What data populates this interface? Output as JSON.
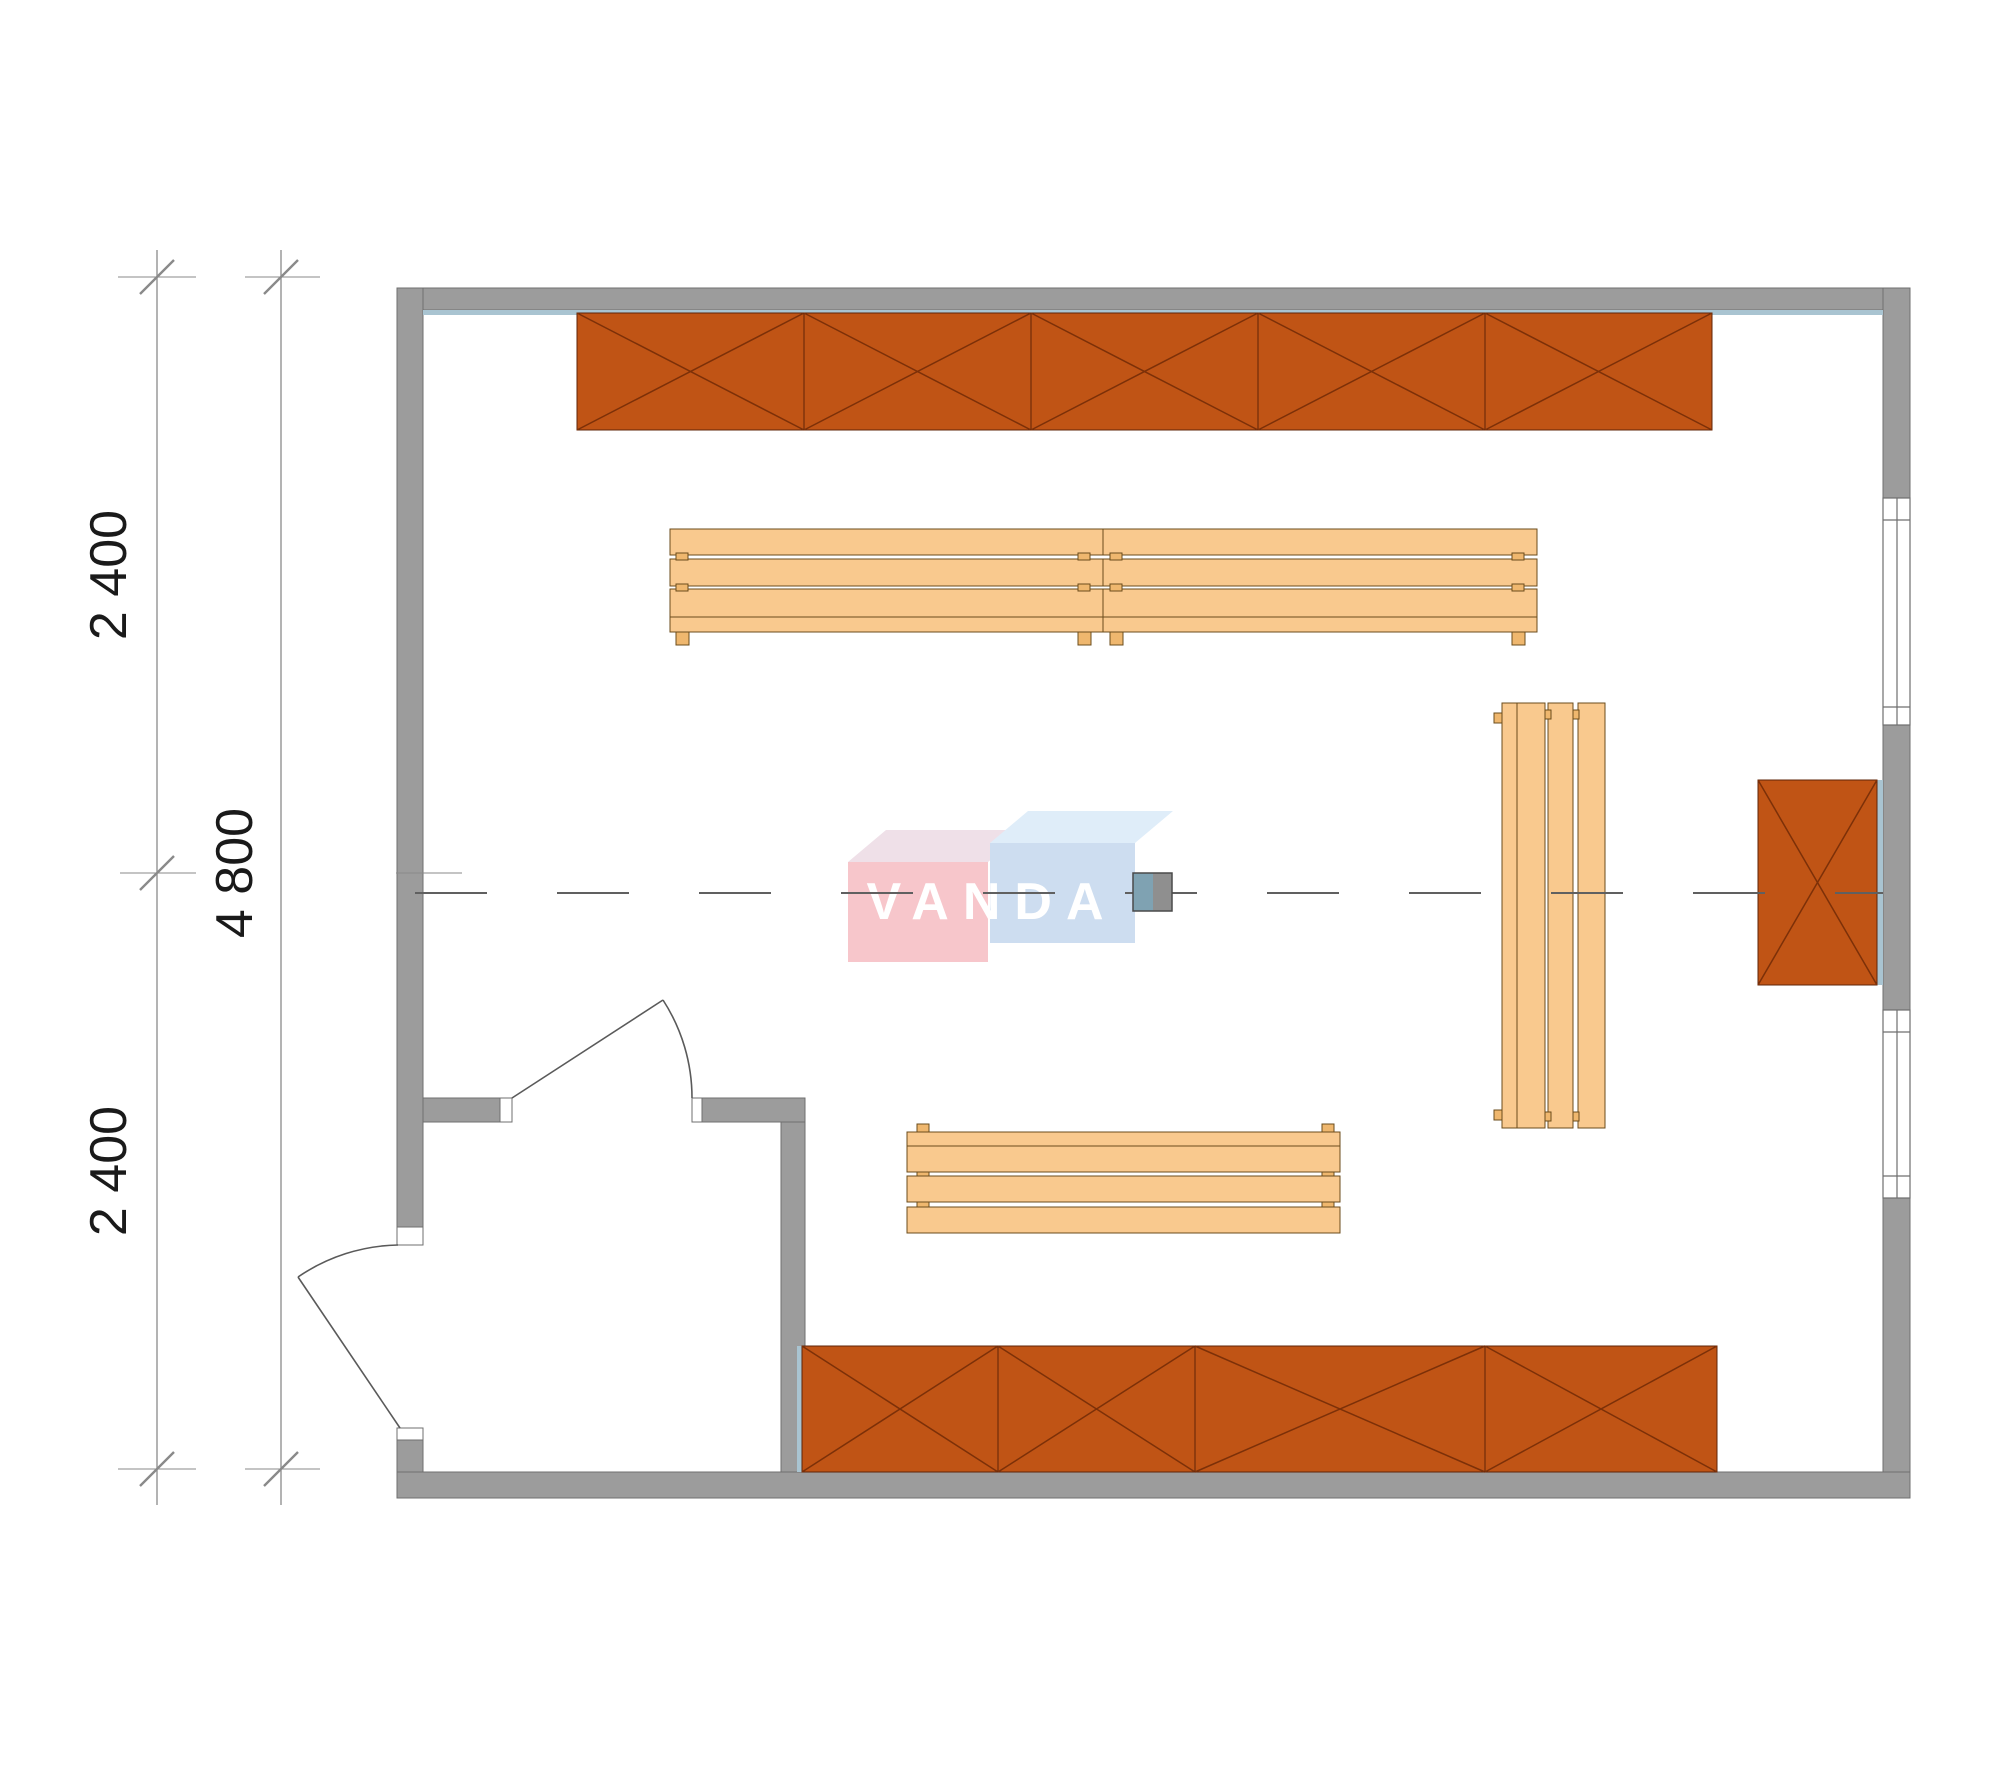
{
  "page": {
    "type": "sauna floor plan drawing",
    "background": "#ffffff"
  },
  "dimensions": {
    "segments": [
      {
        "label": "2 400",
        "position": "top-left"
      },
      {
        "label": "2 400",
        "position": "bottom-left"
      }
    ],
    "total": {
      "label": "4 800",
      "position": "left"
    }
  },
  "watermark": {
    "text": "VANDA"
  },
  "plan_objects": {
    "walls": [
      "top exterior wall",
      "left exterior wall",
      "right exterior wall",
      "bottom exterior wall",
      "vestibule partition walls"
    ],
    "doors": [
      {
        "name": "exterior door",
        "location": "left wall, swings outward"
      },
      {
        "name": "vestibule door",
        "location": "partition wall, swings into room"
      }
    ],
    "windows": [
      {
        "name": "window 1",
        "location": "right wall, upper"
      },
      {
        "name": "window 2",
        "location": "right wall, lower"
      }
    ],
    "shelves": [
      {
        "name": "top wall shelf",
        "cells": 5
      },
      {
        "name": "bottom wall shelf",
        "cells": 4
      },
      {
        "name": "right wall unit",
        "cells": 1
      }
    ],
    "benches": [
      {
        "name": "upper bench",
        "modules": 2,
        "orientation": "horizontal"
      },
      {
        "name": "lower bench",
        "modules": 1,
        "orientation": "horizontal"
      },
      {
        "name": "right bench",
        "modules": 1,
        "orientation": "vertical"
      }
    ],
    "center_fixture": {
      "name": "small square fixture on centerline"
    }
  },
  "colors": {
    "wall": "#9c9c9c",
    "wall_edge": "#6f6f6f",
    "liner": "#a9c4d1",
    "shelf": "#c05415",
    "shelf_edge": "#5f2408",
    "shelf_brace": "#7c3008",
    "bench": "#f9c98e",
    "bench_edge": "#6b4c1c",
    "bench_foot": "#efb76e",
    "line": "#606060",
    "dim": "#8a8a8a",
    "text": "#1a1a1a",
    "heater_left": "#7fa2b2",
    "heater_right": "#8f8f8f",
    "logo_pink": "#f7c6cb",
    "logo_pink_top": "#efe0e8",
    "logo_blue": "#cdddf0",
    "logo_blue_top": "#dfedf9",
    "logo_text": "#ffffff"
  }
}
